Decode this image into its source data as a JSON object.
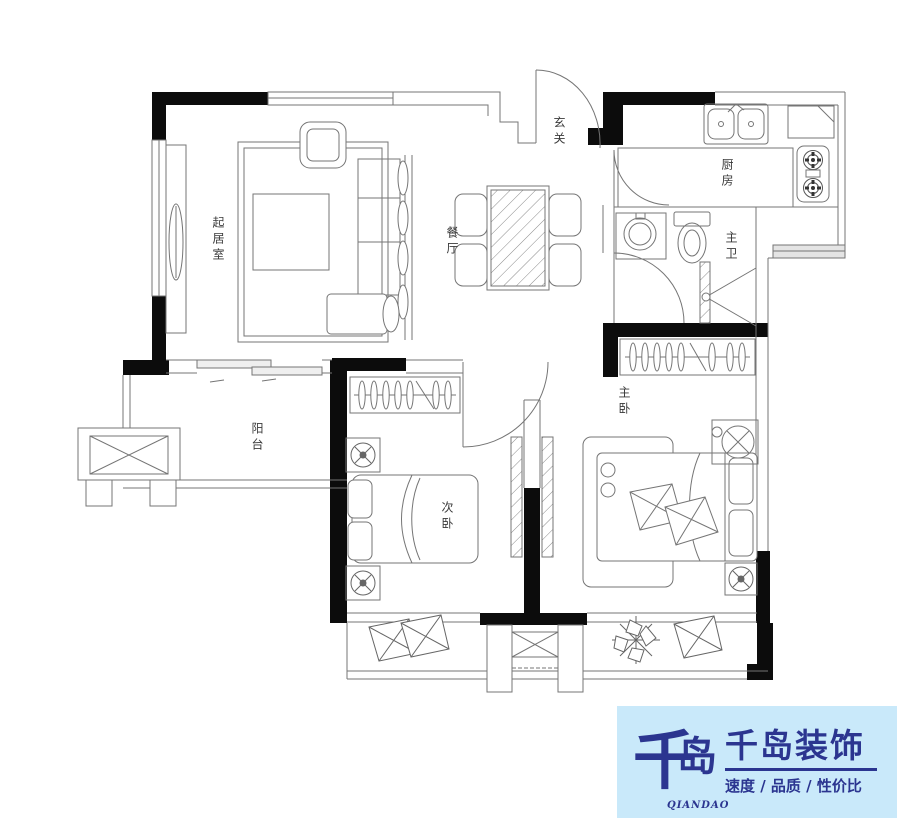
{
  "plan": {
    "rooms": {
      "living_room": "起居室",
      "dining_room": "餐厅",
      "entry": "玄关",
      "kitchen": "厨房",
      "master_bath": "主卫",
      "balcony": "阳台",
      "second_bedroom": "次卧",
      "master_bedroom": "主卧"
    }
  },
  "logo": {
    "mark_char_1": "千",
    "mark_char_2": "岛",
    "roman": "QIANDAO",
    "company": "千岛装饰",
    "tagline": "速度 / 品质 / 性价比",
    "colors": {
      "panel_bg": "#c9e9fa",
      "brand_navy": "#2b3590"
    }
  }
}
